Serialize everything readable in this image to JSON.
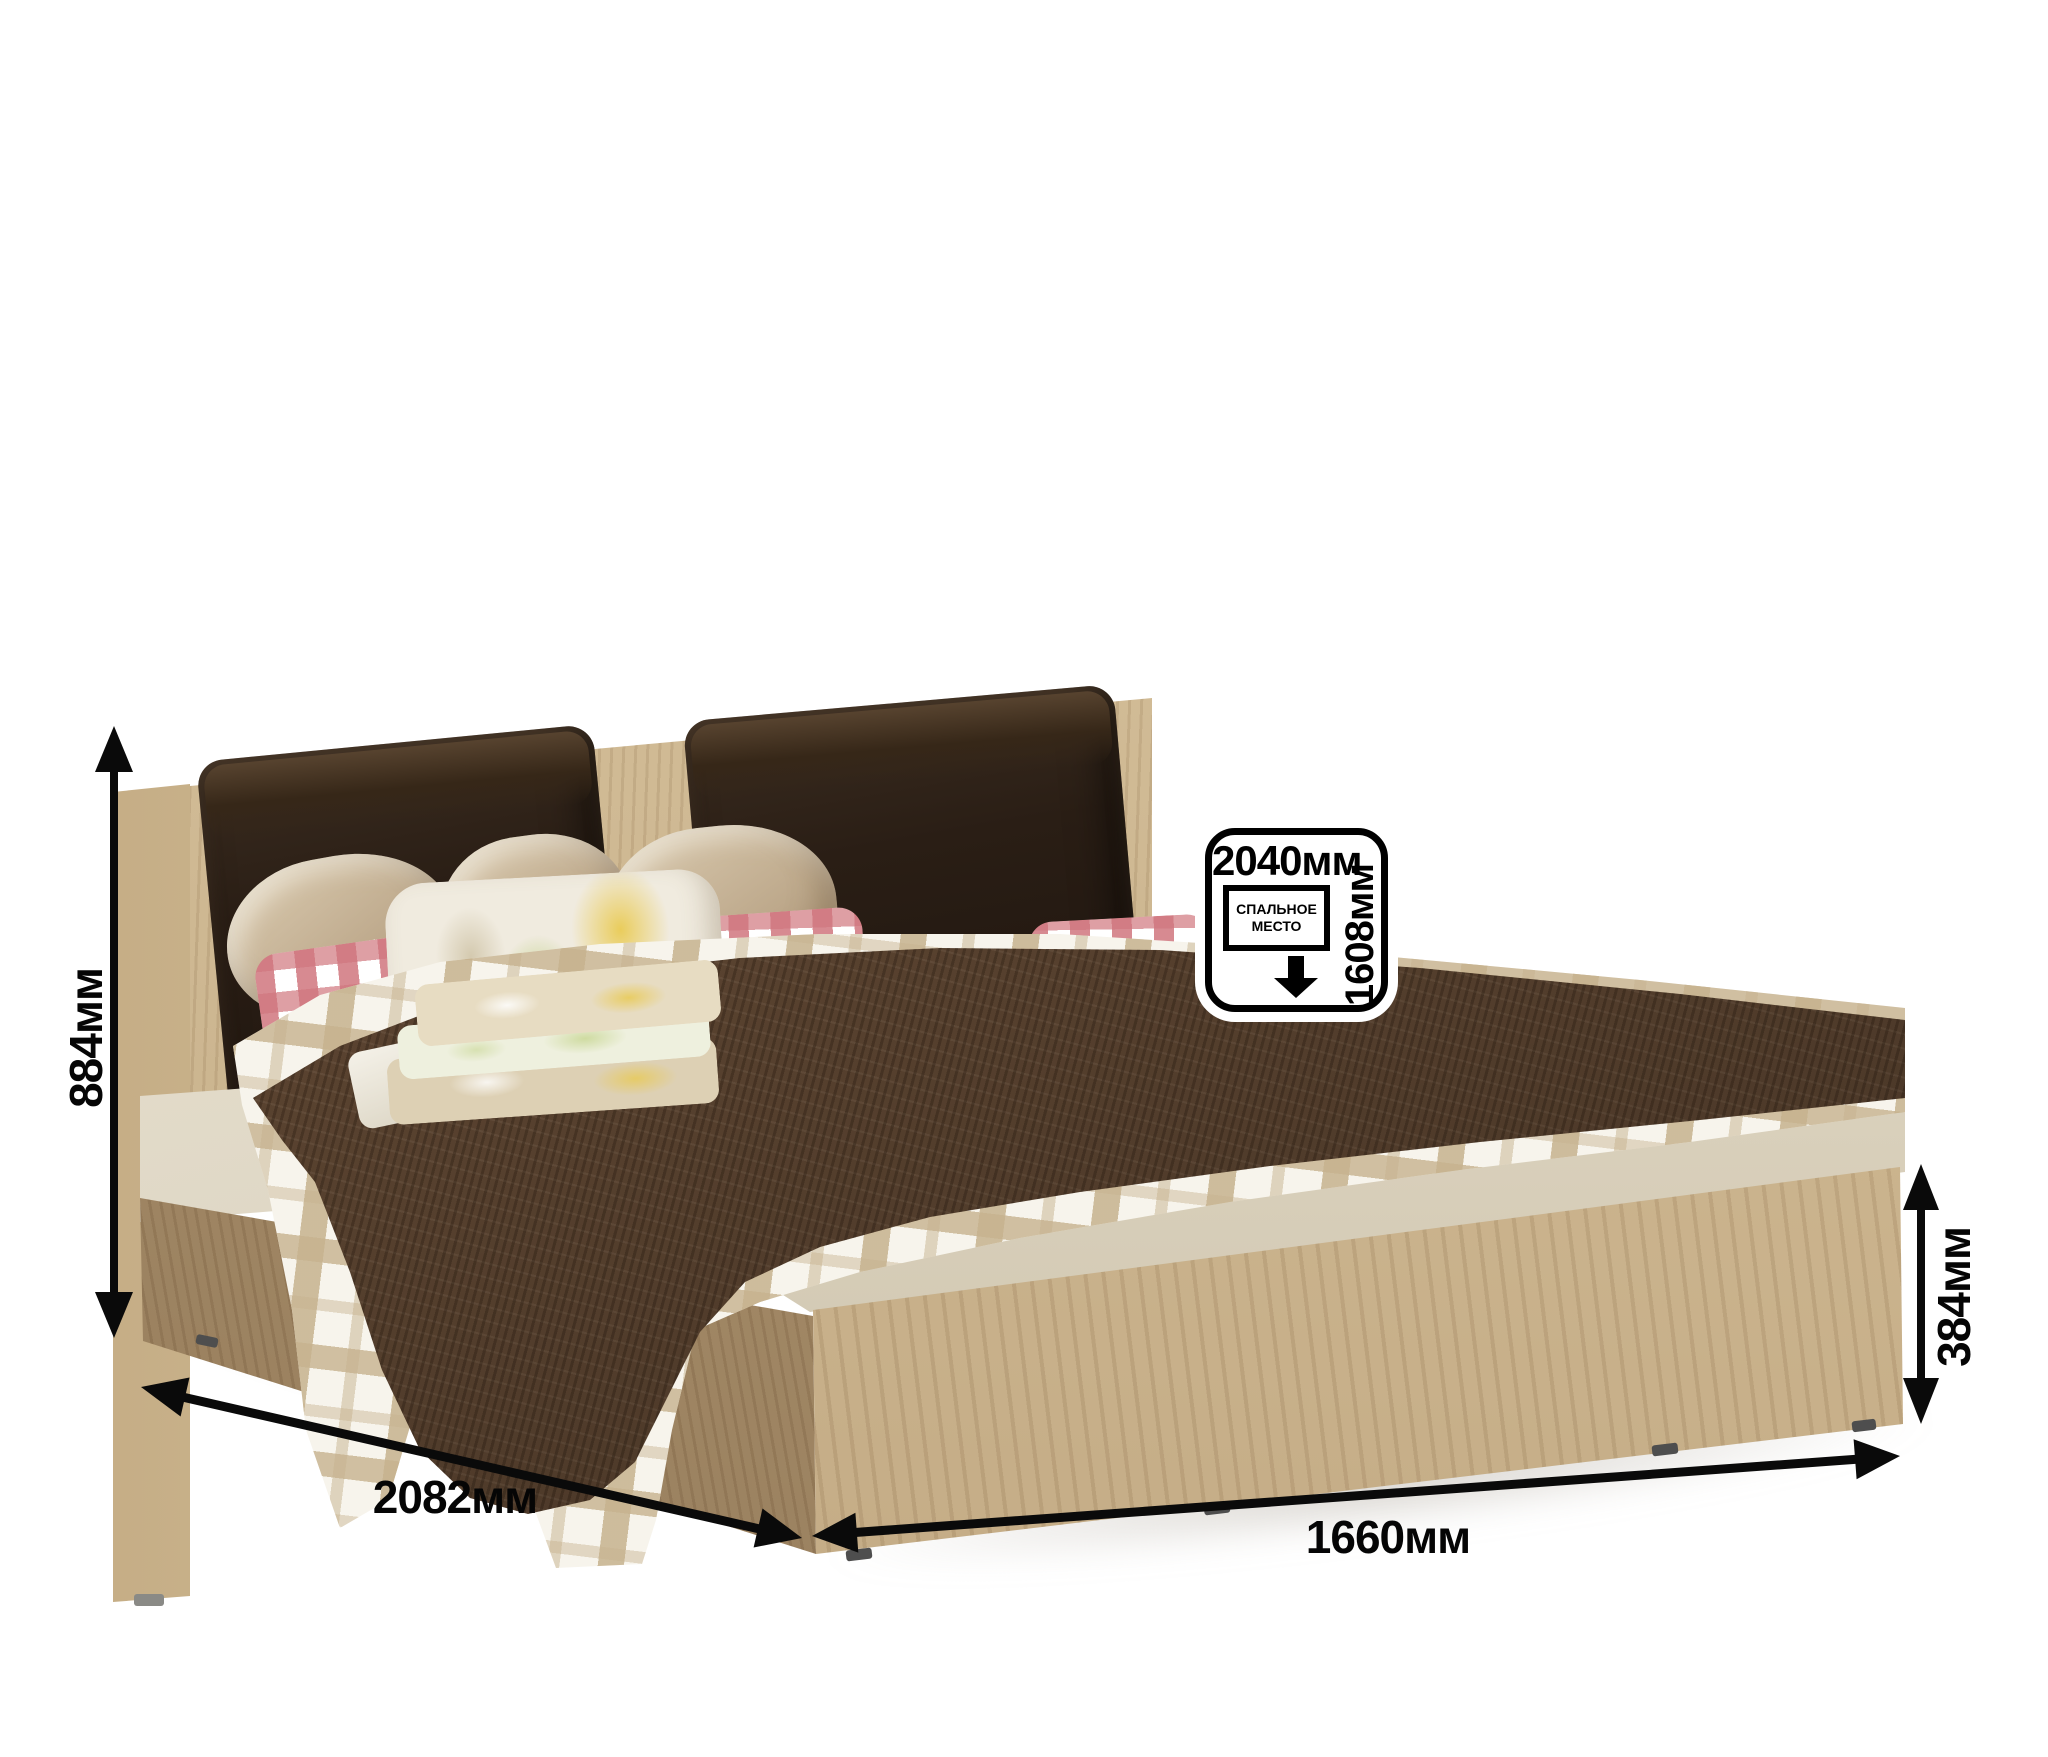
{
  "canvas": {
    "width": 2048,
    "height": 1757,
    "background": "#ffffff"
  },
  "dimensions": {
    "height_label": "884мм",
    "depth_label": "2082мм",
    "width_label": "1660мм",
    "base_height_label": "384мм"
  },
  "badge": {
    "bed_length": "2040мм",
    "bed_width": "1608мм",
    "area_label": "СПАЛЬНОЕ МЕСТО"
  },
  "colors": {
    "wood_light": "#d9c49e",
    "wood_shadow": "#a68b64",
    "cushion_leather": "#2a1d14",
    "blanket_brown": "#5a4330",
    "plaid_beige": "#c6b28e",
    "gingham_pink": "#d0767e",
    "mattress_cream": "#e6dfd0",
    "dimension_black": "#0a0a0a"
  }
}
